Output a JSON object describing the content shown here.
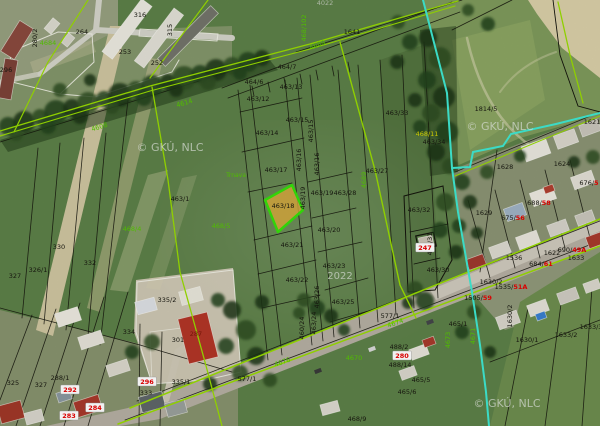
{
  "map": {
    "description": "Cadastral map viewer over aerial orthophoto",
    "watermark": "© GKÚ, NLC",
    "year_stamp": "2022",
    "highlighted_parcel": "463/18",
    "colors": {
      "black": "#181810",
      "green": "#55c800",
      "yellow": "#d6d400",
      "darkred": "#7a1808",
      "red": "#e60000",
      "wm": "rgba(225,230,222,0.72)",
      "wm2": "rgba(205,210,200,0.8)",
      "highlight_fill": "#e0ad3c",
      "highlight_stroke": "#35e00a",
      "cyan_boundary": "#3fe8d2",
      "survey_green": "#98dc00"
    },
    "labels": [
      {
        "t": "280/2",
        "x": 37,
        "y": 38,
        "c": "black",
        "v": 1
      },
      {
        "t": "4684",
        "x": 48,
        "y": 45,
        "c": "green"
      },
      {
        "t": "264",
        "x": 82,
        "y": 34,
        "c": "black"
      },
      {
        "t": "296",
        "x": 6,
        "y": 72,
        "c": "black"
      },
      {
        "t": "316",
        "x": 140,
        "y": 17,
        "c": "black"
      },
      {
        "t": "315",
        "x": 172,
        "y": 30,
        "c": "black",
        "v": 1
      },
      {
        "t": "253",
        "x": 125,
        "y": 54,
        "c": "black"
      },
      {
        "t": "252",
        "x": 157,
        "y": 65,
        "c": "black"
      },
      {
        "t": "4022",
        "x": 325,
        "y": 5,
        "c": "wm2"
      },
      {
        "t": "468/102",
        "x": 306,
        "y": 28,
        "c": "green",
        "v": 1
      },
      {
        "t": "4689",
        "x": 318,
        "y": 47,
        "c": "green",
        "rot": -20
      },
      {
        "t": "1641",
        "x": 352,
        "y": 34,
        "c": "black"
      },
      {
        "t": "464/7",
        "x": 287,
        "y": 69,
        "c": "black"
      },
      {
        "t": "464/6",
        "x": 254,
        "y": 84,
        "c": "black"
      },
      {
        "t": "463/13",
        "x": 291,
        "y": 89,
        "c": "black"
      },
      {
        "t": "463/12",
        "x": 258,
        "y": 101,
        "c": "black"
      },
      {
        "t": "463/15",
        "x": 297,
        "y": 122,
        "c": "black"
      },
      {
        "t": "463/15",
        "x": 313,
        "y": 131,
        "c": "black",
        "v": 1
      },
      {
        "t": "463/14",
        "x": 267,
        "y": 135,
        "c": "black"
      },
      {
        "t": "463/33",
        "x": 397,
        "y": 115,
        "c": "black"
      },
      {
        "t": "1814/5",
        "x": 486,
        "y": 111,
        "c": "black"
      },
      {
        "t": "1621",
        "x": 592,
        "y": 124,
        "c": "black"
      },
      {
        "t": "468/11",
        "x": 427,
        "y": 136,
        "c": "yellow"
      },
      {
        "t": "463/34",
        "x": 434,
        "y": 144,
        "c": "black"
      },
      {
        "t": "Trnava",
        "x": 236,
        "y": 177,
        "c": "green",
        "s": 6
      },
      {
        "t": "463/17",
        "x": 276,
        "y": 172,
        "c": "black"
      },
      {
        "t": "463/16",
        "x": 301,
        "y": 160,
        "c": "black",
        "v": 1
      },
      {
        "t": "463/16",
        "x": 319,
        "y": 164,
        "c": "black",
        "v": 1
      },
      {
        "t": "463/1",
        "x": 180,
        "y": 201,
        "c": "black"
      },
      {
        "t": "468/4",
        "x": 132,
        "y": 231,
        "c": "green"
      },
      {
        "t": "468/5",
        "x": 221,
        "y": 228,
        "c": "green"
      },
      {
        "t": "463/18",
        "x": 283,
        "y": 208,
        "c": "black"
      },
      {
        "t": "463/19",
        "x": 305,
        "y": 198,
        "c": "black",
        "v": 1
      },
      {
        "t": "463/19",
        "x": 322,
        "y": 195,
        "c": "black"
      },
      {
        "t": "463/28",
        "x": 345,
        "y": 195,
        "c": "black"
      },
      {
        "t": "463/27",
        "x": 377,
        "y": 173,
        "c": "black"
      },
      {
        "t": "4689",
        "x": 366,
        "y": 180,
        "c": "green",
        "v": 1
      },
      {
        "t": "463/20",
        "x": 329,
        "y": 232,
        "c": "black"
      },
      {
        "t": "463/21",
        "x": 292,
        "y": 247,
        "c": "black"
      },
      {
        "t": "463/32",
        "x": 419,
        "y": 212,
        "c": "black"
      },
      {
        "t": "463/31",
        "x": 432,
        "y": 244,
        "c": "black",
        "v": 1
      },
      {
        "t": "247",
        "x": 425,
        "y": 250,
        "c": "red",
        "p": 1
      },
      {
        "t": "463/30",
        "x": 438,
        "y": 272,
        "c": "black"
      },
      {
        "t": "463/23",
        "x": 334,
        "y": 268,
        "c": "black"
      },
      {
        "t": "2022",
        "x": 340,
        "y": 279,
        "c": "wm",
        "s": 10
      },
      {
        "t": "463/22",
        "x": 297,
        "y": 282,
        "c": "black"
      },
      {
        "t": "463/26",
        "x": 319,
        "y": 297,
        "c": "black",
        "v": 1
      },
      {
        "t": "463/25",
        "x": 343,
        "y": 304,
        "c": "black"
      },
      {
        "t": "463/24",
        "x": 316,
        "y": 323,
        "c": "black",
        "v": 1
      },
      {
        "t": "460/24",
        "x": 304,
        "y": 328,
        "c": "black",
        "v": 1
      },
      {
        "t": "330",
        "x": 59,
        "y": 249,
        "c": "black"
      },
      {
        "t": "332",
        "x": 90,
        "y": 265,
        "c": "black"
      },
      {
        "t": "326/1",
        "x": 38,
        "y": 272,
        "c": "black"
      },
      {
        "t": "327",
        "x": 15,
        "y": 278,
        "c": "black"
      },
      {
        "t": "325",
        "x": 13,
        "y": 385,
        "c": "black"
      },
      {
        "t": "327",
        "x": 41,
        "y": 387,
        "c": "black"
      },
      {
        "t": "288/1",
        "x": 60,
        "y": 380,
        "c": "black"
      },
      {
        "t": "292",
        "x": 70,
        "y": 392,
        "c": "red",
        "p": 1
      },
      {
        "t": "283",
        "x": 69,
        "y": 418,
        "c": "red",
        "p": 1
      },
      {
        "t": "284",
        "x": 95,
        "y": 410,
        "c": "red",
        "p": 1
      },
      {
        "t": "335/2",
        "x": 167,
        "y": 302,
        "c": "black"
      },
      {
        "t": "334",
        "x": 129,
        "y": 334,
        "c": "black"
      },
      {
        "t": "301",
        "x": 178,
        "y": 342,
        "c": "black"
      },
      {
        "t": "287",
        "x": 196,
        "y": 336,
        "c": "darkred"
      },
      {
        "t": "296",
        "x": 147,
        "y": 384,
        "c": "red",
        "p": 1
      },
      {
        "t": "333",
        "x": 146,
        "y": 395,
        "c": "black"
      },
      {
        "t": "335/1",
        "x": 181,
        "y": 384,
        "c": "black"
      },
      {
        "t": "577/1",
        "x": 247,
        "y": 381,
        "c": "black"
      },
      {
        "t": "4676",
        "x": 283,
        "y": 364,
        "c": "green",
        "rot": -19
      },
      {
        "t": "577/1",
        "x": 390,
        "y": 318,
        "c": "black"
      },
      {
        "t": "4674",
        "x": 396,
        "y": 325,
        "c": "green",
        "rot": -19
      },
      {
        "t": "4670",
        "x": 354,
        "y": 360,
        "c": "green"
      },
      {
        "t": "468/9",
        "x": 357,
        "y": 421,
        "c": "black"
      },
      {
        "t": "488/2",
        "x": 399,
        "y": 349,
        "c": "black"
      },
      {
        "t": "280",
        "x": 402,
        "y": 358,
        "c": "red",
        "p": 1
      },
      {
        "t": "488/14",
        "x": 400,
        "y": 367,
        "c": "black"
      },
      {
        "t": "465/5",
        "x": 421,
        "y": 382,
        "c": "black"
      },
      {
        "t": "465/6",
        "x": 407,
        "y": 394,
        "c": "black"
      },
      {
        "t": "465/1",
        "x": 458,
        "y": 326,
        "c": "black"
      },
      {
        "t": "4671",
        "x": 475,
        "y": 336,
        "c": "green",
        "v": 1
      },
      {
        "t": "4673",
        "x": 450,
        "y": 340,
        "c": "green",
        "v": 1
      },
      {
        "t": "1629",
        "x": 484,
        "y": 215,
        "c": "black"
      },
      {
        "t": "1628",
        "x": 505,
        "y": 169,
        "c": "black"
      },
      {
        "t": "1624",
        "x": 562,
        "y": 166,
        "c": "black"
      },
      {
        "t": "1622",
        "x": 552,
        "y": 255,
        "c": "black"
      },
      {
        "t": "675/",
        "x": 513,
        "y": 220,
        "c": "black",
        "r": "56"
      },
      {
        "t": "688/",
        "x": 539,
        "y": 205,
        "c": "black",
        "r": "58"
      },
      {
        "t": "676/",
        "x": 589,
        "y": 185,
        "c": "black",
        "r": "5"
      },
      {
        "t": "1505/",
        "x": 478,
        "y": 300,
        "c": "black",
        "r": "59"
      },
      {
        "t": "1535/",
        "x": 511,
        "y": 289,
        "c": "black",
        "r": "51A"
      },
      {
        "t": "684/",
        "x": 541,
        "y": 266,
        "c": "black",
        "r": "61"
      },
      {
        "t": "1536",
        "x": 514,
        "y": 260,
        "c": "black"
      },
      {
        "t": "690/",
        "x": 572,
        "y": 252,
        "c": "black",
        "r": "49A"
      },
      {
        "t": "1630/2",
        "x": 491,
        "y": 284,
        "c": "black"
      },
      {
        "t": "1630/2",
        "x": 512,
        "y": 316,
        "c": "black",
        "v": 1
      },
      {
        "t": "1630/1",
        "x": 527,
        "y": 342,
        "c": "black"
      },
      {
        "t": "1633/2",
        "x": 566,
        "y": 337,
        "c": "black"
      },
      {
        "t": "1633/3",
        "x": 591,
        "y": 329,
        "c": "black"
      },
      {
        "t": "1633",
        "x": 576,
        "y": 260,
        "c": "black"
      },
      {
        "t": "4608",
        "x": 100,
        "y": 129,
        "c": "green",
        "rot": -17
      },
      {
        "t": "4614",
        "x": 185,
        "y": 105,
        "c": "green",
        "rot": -17
      },
      {
        "t": "© GKÚ, NLC",
        "x": 170,
        "y": 151,
        "c": "wm",
        "s": 11
      },
      {
        "t": "© GKÚ, NLC",
        "x": 500,
        "y": 130,
        "c": "wm",
        "s": 11
      },
      {
        "t": "© GKÚ, NLC",
        "x": 507,
        "y": 407,
        "c": "wm",
        "s": 11
      }
    ]
  }
}
